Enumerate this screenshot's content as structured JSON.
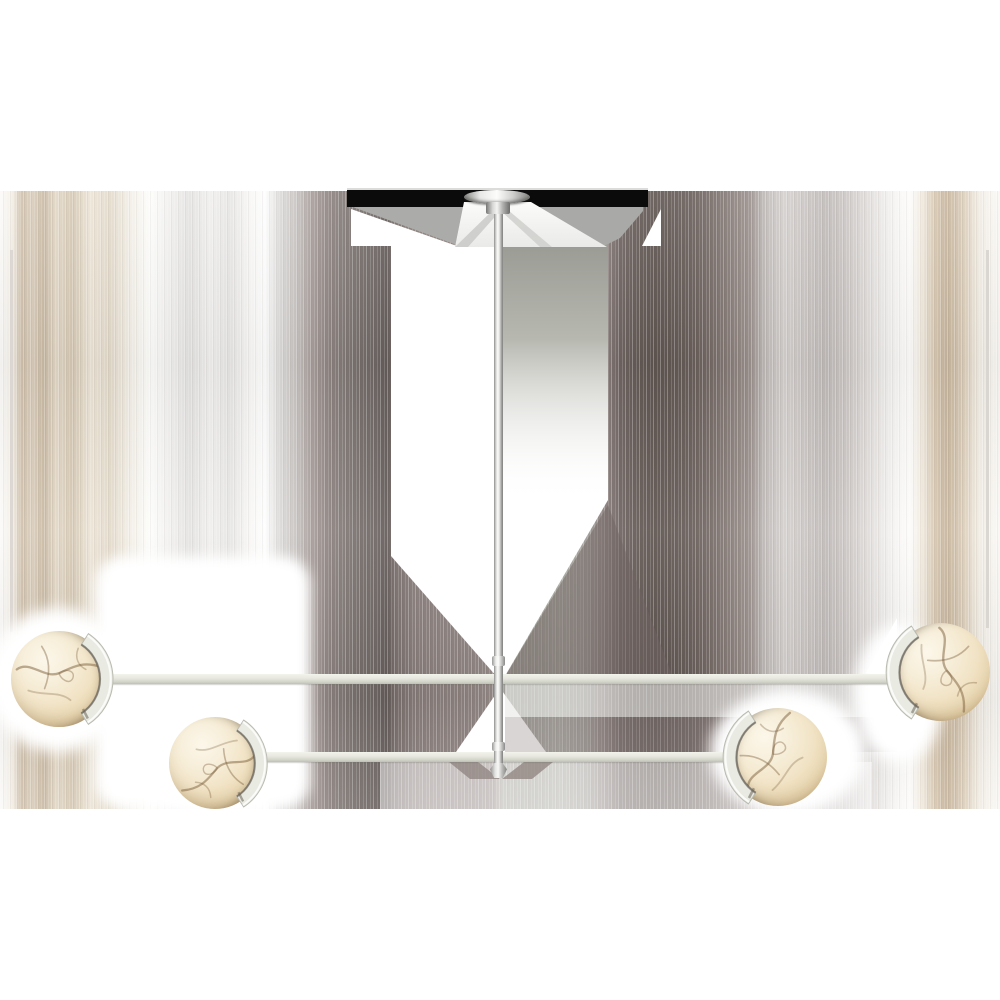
{
  "image": {
    "alt": "Product photo of a two-tier linear chandelier in polished nickel with four alabaster globe shades hanging from a center downrod, shown on a white background with vertical glitch-smear artifacts and a black ceiling band",
    "background": "#ffffff"
  },
  "colors": {
    "nickel_light": "#fbfbf9",
    "nickel_dark": "#7f7f7d",
    "arm_light": "#f2f3eb",
    "arm_mid": "#e6e7df",
    "arm_dark": "#bfc0b6",
    "alabaster_light": "#fcf7ea",
    "alabaster_mid": "#f1e3c5",
    "alabaster_deep": "#c3a87c",
    "vein": "#7c5f3c",
    "ceiling_band_black": "#0b0b0b",
    "trapezoid_gray": "#ababa9",
    "pillar_gray": "#8f9089",
    "halo_white": "#ffffff"
  },
  "stripes": {
    "band_top": 191,
    "band_height": 618,
    "stops": [
      [
        0,
        "#fcfbf9"
      ],
      [
        1.2,
        "#f4efe7"
      ],
      [
        2.2,
        "#cfc0ab"
      ],
      [
        3.2,
        "#dacdbb"
      ],
      [
        4.4,
        "#c9baa3"
      ],
      [
        5.6,
        "#e3d8c7"
      ],
      [
        7.2,
        "#d5c8b3"
      ],
      [
        9,
        "#ece4d6"
      ],
      [
        11,
        "#e3daca"
      ],
      [
        13,
        "#f3efe7"
      ],
      [
        15,
        "#fdfdfb"
      ],
      [
        17,
        "#f1f0ee"
      ],
      [
        19,
        "#e4e3e1"
      ],
      [
        21,
        "#f0efed"
      ],
      [
        23,
        "#e7e6e4"
      ],
      [
        25,
        "#f8f7f5"
      ],
      [
        26.5,
        "#fefefe"
      ],
      [
        28,
        "#dcdad8"
      ],
      [
        29.6,
        "#c8c4c2"
      ],
      [
        31.2,
        "#a89e9b"
      ],
      [
        33,
        "#8d8380"
      ],
      [
        34.6,
        "#807875"
      ],
      [
        36.2,
        "#756d6a"
      ],
      [
        37.6,
        "#6f6765"
      ],
      [
        38.7,
        "#645c5a"
      ],
      [
        39.5,
        "#796f6c"
      ],
      [
        41.5,
        "#887d7a"
      ],
      [
        44,
        "#8c817e"
      ],
      [
        47,
        "#8f8481"
      ],
      [
        49.3,
        "#968b88"
      ],
      [
        49.8,
        "#a59d98"
      ],
      [
        50.3,
        "#a8a79f"
      ],
      [
        53,
        "#a4a39b"
      ],
      [
        56,
        "#aaa9a1"
      ],
      [
        58.5,
        "#a09d97"
      ],
      [
        60.5,
        "#8b807d"
      ],
      [
        62,
        "#6f6461"
      ],
      [
        63.6,
        "#655b57"
      ],
      [
        65.5,
        "#5f5551"
      ],
      [
        67.5,
        "#635955"
      ],
      [
        69.5,
        "#6a5f5b"
      ],
      [
        71.5,
        "#796e6a"
      ],
      [
        73.5,
        "#8d827e"
      ],
      [
        75,
        "#9b918d"
      ],
      [
        76.5,
        "#c0bbb9"
      ],
      [
        78.5,
        "#d4d0ce"
      ],
      [
        80.5,
        "#cac5c3"
      ],
      [
        82.5,
        "#c0bbb9"
      ],
      [
        84.5,
        "#cbc6c4"
      ],
      [
        86.5,
        "#ddd9d7"
      ],
      [
        88.5,
        "#efedeb"
      ],
      [
        90,
        "#f9f8f6"
      ],
      [
        91,
        "#fdfcfa"
      ],
      [
        92.2,
        "#f0e9de"
      ],
      [
        93.4,
        "#d8c9b3"
      ],
      [
        94.6,
        "#c8b69e"
      ],
      [
        95.8,
        "#d3c4ae"
      ],
      [
        96.8,
        "#e2d6c4"
      ],
      [
        97.8,
        "#f0ebe2"
      ],
      [
        99,
        "#f7f4ef"
      ],
      [
        100,
        "#faf8f4"
      ]
    ]
  },
  "fixture": {
    "canopy": {
      "disc": {
        "x": 464,
        "y": 190,
        "w": 66,
        "h": 14
      },
      "hub": {
        "x": 486,
        "y": 202,
        "w": 24,
        "h": 12
      }
    },
    "rod": {
      "x": 494,
      "w": 9,
      "top": 205,
      "bottom": 766
    },
    "couplers": [
      {
        "name": "rod-coupler-upper",
        "x": 492,
        "y": 656,
        "w": 13,
        "h": 10
      },
      {
        "name": "rod-coupler-lower",
        "x": 492,
        "y": 742,
        "w": 13,
        "h": 9
      }
    ],
    "tip": {
      "x": 490,
      "y": 763,
      "w": 17,
      "h": 15
    },
    "arms": [
      {
        "name": "upper-arm",
        "x1": 107,
        "x2": 895,
        "y": 674,
        "h": 10
      },
      {
        "name": "lower-arm",
        "x1": 266,
        "x2": 734,
        "y": 752,
        "h": 10
      }
    ],
    "spheres": [
      {
        "name": "globe-left-outer",
        "cx": 59,
        "cy": 679,
        "r": 48,
        "bracket": "right",
        "veins_rotation": 0
      },
      {
        "name": "globe-left-inner",
        "cx": 215,
        "cy": 763,
        "r": 46,
        "bracket": "right",
        "veins_rotation": 155
      },
      {
        "name": "globe-right-inner",
        "cx": 778,
        "cy": 757,
        "r": 49,
        "bracket": "left",
        "veins_rotation": 300
      },
      {
        "name": "globe-right-outer",
        "cx": 941,
        "cy": 672,
        "r": 49,
        "bracket": "left",
        "veins_rotation": 75
      }
    ]
  }
}
